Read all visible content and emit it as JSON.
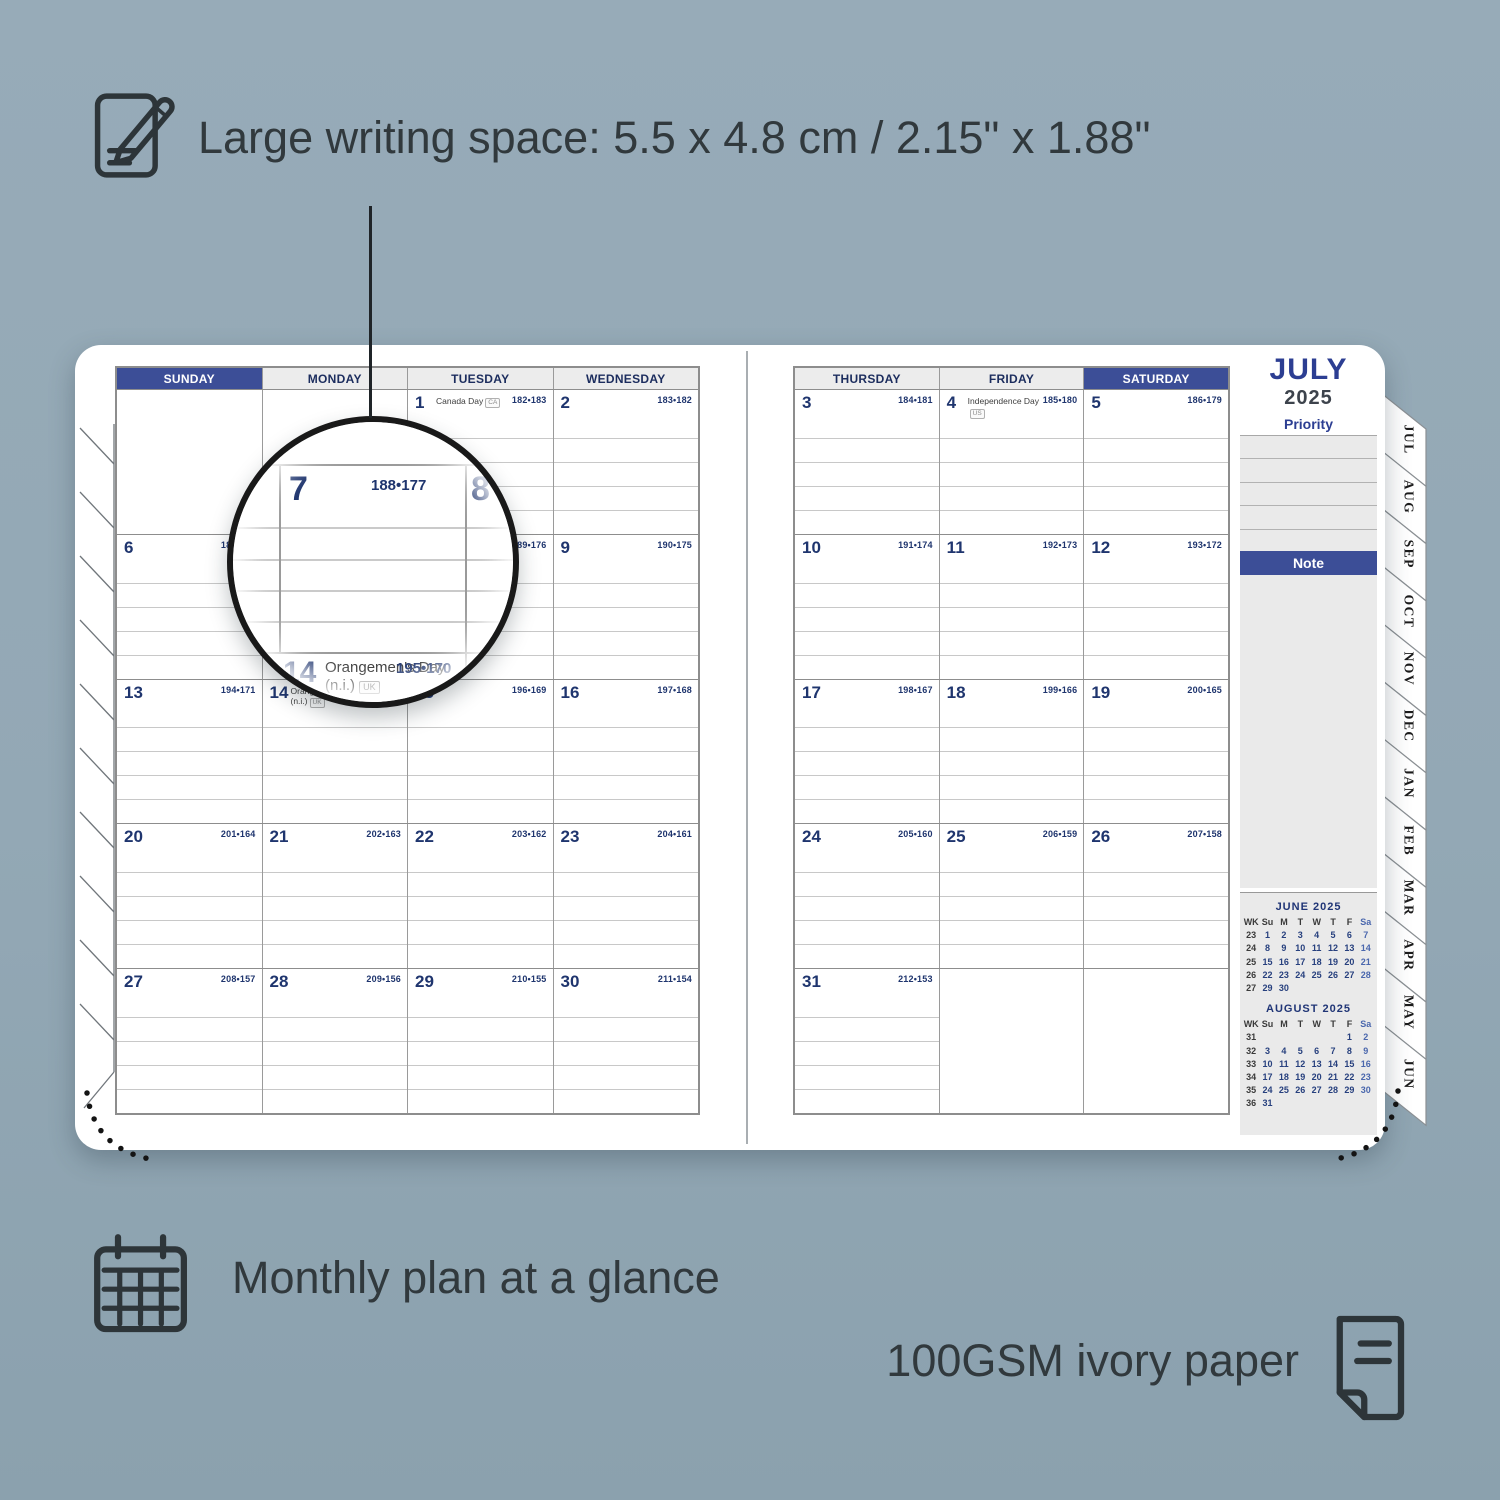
{
  "colors": {
    "background": "#93a8b5",
    "accent_navy": "#3c4e97",
    "number_navy": "#1f356e",
    "annotation_text": "#31393d",
    "panel_gray": "#eaeaea"
  },
  "annotations": {
    "top": "Large writing space: 5.5 x 4.8 cm / 2.15\" x 1.88\"",
    "bottom_left": "Monthly plan at a glance",
    "bottom_right": "100GSM ivory paper"
  },
  "planner": {
    "month_title": "JULY",
    "year": "2025",
    "priority_label": "Priority",
    "note_label": "Note",
    "priority_rows": 5,
    "left_page": {
      "headers": [
        {
          "label": "SUNDAY",
          "highlight": true
        },
        {
          "label": "MONDAY"
        },
        {
          "label": "TUESDAY"
        },
        {
          "label": "WEDNESDAY"
        }
      ],
      "weeks": [
        [
          {
            "lines": false
          },
          {
            "lines": false
          },
          {
            "day": "1",
            "holiday": "Canada Day",
            "badge": "CA",
            "pair": "182•183"
          },
          {
            "day": "2",
            "pair": "183•182"
          }
        ],
        [
          {
            "day": "6",
            "pair": "187•178"
          },
          {
            "day": "7",
            "pair": "188•177"
          },
          {
            "day": "8",
            "pair": "189•176"
          },
          {
            "day": "9",
            "pair": "190•175"
          }
        ],
        [
          {
            "day": "13",
            "pair": "194•171"
          },
          {
            "day": "14",
            "holiday": "Orangemen's Day (n.i.)",
            "badge": "UK",
            "pair": "195•170"
          },
          {
            "day": "15",
            "pair": "196•169"
          },
          {
            "day": "16",
            "pair": "197•168"
          }
        ],
        [
          {
            "day": "20",
            "pair": "201•164"
          },
          {
            "day": "21",
            "pair": "202•163"
          },
          {
            "day": "22",
            "pair": "203•162"
          },
          {
            "day": "23",
            "pair": "204•161"
          }
        ],
        [
          {
            "day": "27",
            "pair": "208•157"
          },
          {
            "day": "28",
            "pair": "209•156"
          },
          {
            "day": "29",
            "pair": "210•155"
          },
          {
            "day": "30",
            "pair": "211•154"
          }
        ]
      ]
    },
    "right_page": {
      "headers": [
        {
          "label": "THURSDAY"
        },
        {
          "label": "FRIDAY"
        },
        {
          "label": "SATURDAY",
          "highlight": true
        }
      ],
      "weeks": [
        [
          {
            "day": "3",
            "pair": "184•181"
          },
          {
            "day": "4",
            "holiday": "Independence Day",
            "badge": "US",
            "pair": "185•180"
          },
          {
            "day": "5",
            "pair": "186•179"
          }
        ],
        [
          {
            "day": "10",
            "pair": "191•174"
          },
          {
            "day": "11",
            "pair": "192•173"
          },
          {
            "day": "12",
            "pair": "193•172"
          }
        ],
        [
          {
            "day": "17",
            "pair": "198•167"
          },
          {
            "day": "18",
            "pair": "199•166"
          },
          {
            "day": "19",
            "pair": "200•165"
          }
        ],
        [
          {
            "day": "24",
            "pair": "205•160"
          },
          {
            "day": "25",
            "pair": "206•159"
          },
          {
            "day": "26",
            "pair": "207•158"
          }
        ],
        [
          {
            "day": "31",
            "pair": "212•153"
          },
          {
            "lines": false
          },
          {
            "lines": false
          }
        ]
      ]
    },
    "tabs": [
      "JUL",
      "AUG",
      "SEP",
      "OCT",
      "NOV",
      "DEC",
      "JAN",
      "FEB",
      "MAR",
      "APR",
      "MAY",
      "JUN"
    ],
    "mini_calendars": [
      {
        "title": "JUNE 2025",
        "headers": [
          "WK",
          "Su",
          "M",
          "T",
          "W",
          "T",
          "F",
          "Sa"
        ],
        "rows": [
          [
            "23",
            "1",
            "2",
            "3",
            "4",
            "5",
            "6",
            "7"
          ],
          [
            "24",
            "8",
            "9",
            "10",
            "11",
            "12",
            "13",
            "14"
          ],
          [
            "25",
            "15",
            "16",
            "17",
            "18",
            "19",
            "20",
            "21"
          ],
          [
            "26",
            "22",
            "23",
            "24",
            "25",
            "26",
            "27",
            "28"
          ],
          [
            "27",
            "29",
            "30",
            "",
            "",
            "",
            "",
            ""
          ]
        ]
      },
      {
        "title": "AUGUST 2025",
        "headers": [
          "WK",
          "Su",
          "M",
          "T",
          "W",
          "T",
          "F",
          "Sa"
        ],
        "rows": [
          [
            "31",
            "",
            "",
            "",
            "",
            "",
            "1",
            "2"
          ],
          [
            "32",
            "3",
            "4",
            "5",
            "6",
            "7",
            "8",
            "9"
          ],
          [
            "33",
            "10",
            "11",
            "12",
            "13",
            "14",
            "15",
            "16"
          ],
          [
            "34",
            "17",
            "18",
            "19",
            "20",
            "21",
            "22",
            "23"
          ],
          [
            "35",
            "24",
            "25",
            "26",
            "27",
            "28",
            "29",
            "30"
          ],
          [
            "36",
            "31",
            "",
            "",
            "",
            "",
            "",
            ""
          ]
        ]
      }
    ],
    "magnifier": {
      "fragment_left": "78",
      "day": "7",
      "pair": "188•177",
      "next_day": "8",
      "bottom_day": "14",
      "bottom_holiday": "Orangemen's Day",
      "bottom_note": "(n.i.)",
      "bottom_badge": "UK",
      "bottom_pair": "195•170"
    }
  }
}
